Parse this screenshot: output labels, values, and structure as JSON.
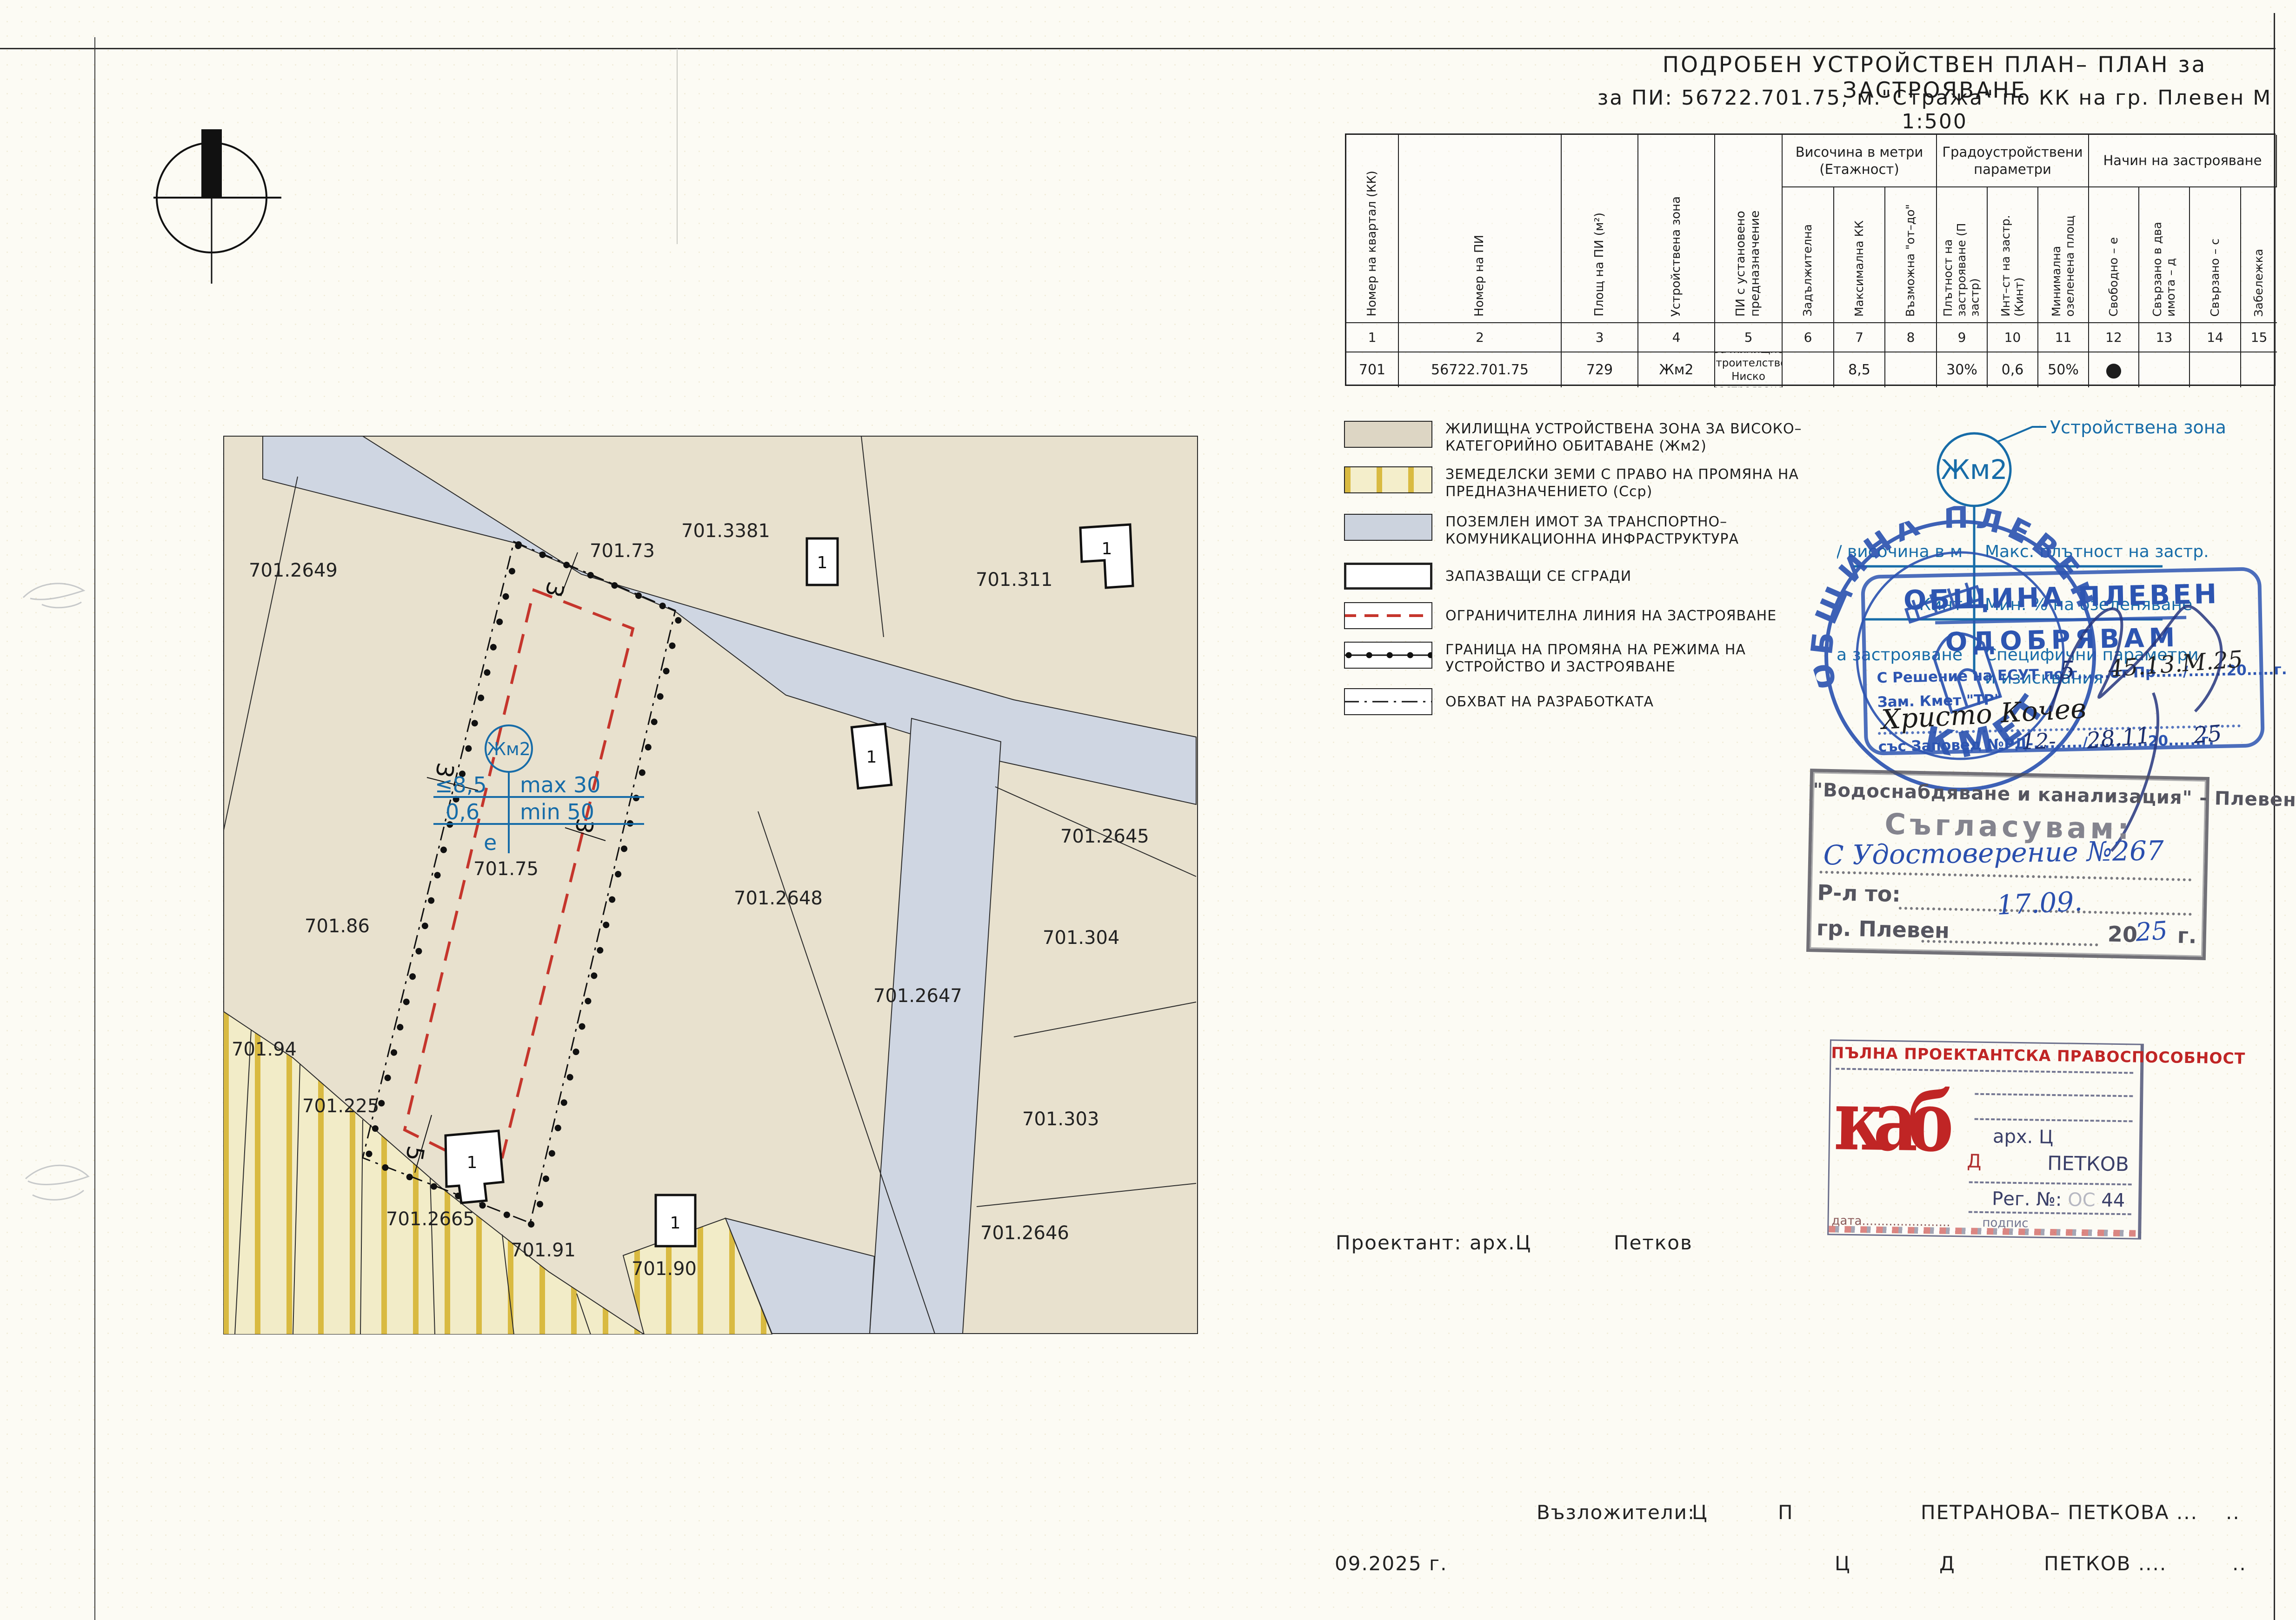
{
  "title": {
    "line1": "ПОДРОБЕН  УСТРОЙСТВЕН  ПЛАН– ПЛАН  за  ЗАСТРОЯВАНЕ",
    "line2": "за  ПИ: 56722.701.75,  м.\"Стража\"  по  КК  на  гр. Плевен  М 1:500"
  },
  "table": {
    "groups": [
      {
        "label": "Височина в метри (Етажност)"
      },
      {
        "label": "Градоустройствени параметри"
      },
      {
        "label": "Начин на застрояване"
      }
    ],
    "columns": [
      {
        "n": "1",
        "label": "Номер на квартал (КК)"
      },
      {
        "n": "2",
        "label": "Номер на ПИ"
      },
      {
        "n": "3",
        "label": "Площ на ПИ (м²)"
      },
      {
        "n": "4",
        "label": "Устройствена зона"
      },
      {
        "n": "5",
        "label": "ПИ с установено предназначение"
      },
      {
        "n": "6",
        "label": "Задължителна"
      },
      {
        "n": "7",
        "label": "Максимална КК"
      },
      {
        "n": "8",
        "label": "Възможна \"от–до\""
      },
      {
        "n": "9",
        "label": "Плътност на застрояване (П застр)"
      },
      {
        "n": "10",
        "label": "Инт–ст на застр. (Кинт)"
      },
      {
        "n": "11",
        "label": "Минимална озеленена площ"
      },
      {
        "n": "12",
        "label": "Свободно – е"
      },
      {
        "n": "13",
        "label": "Свързано в два имота – д"
      },
      {
        "n": "14",
        "label": "Свързано – с"
      },
      {
        "n": "15",
        "label": "Забележка"
      }
    ],
    "row": {
      "c1": "701",
      "c2": "56722.701.75",
      "c3": "729",
      "c4": "Жм2",
      "c5a": "За жилищно строителство",
      "c5b": "Ниско застрояване",
      "c6": "",
      "c7": "8,5",
      "c8": "",
      "c9": "30%",
      "c10": "0,6",
      "c11": "50%",
      "c12": "●",
      "c13": "",
      "c14": "",
      "c15": ""
    }
  },
  "legend": {
    "items": [
      {
        "label": "ЖИЛИЩНА УСТРОЙСТВЕНА ЗОНА ЗА ВИСОКО– КАТЕГОРИЙНО ОБИТАВАНЕ (Жм2)"
      },
      {
        "label": "ЗЕМЕДЕЛСКИ ЗЕМИ С ПРАВО НА ПРОМЯНА НА ПРЕДНАЗНАЧЕНИЕТО (Сср)"
      },
      {
        "label": "ПОЗЕМЛЕН ИМОТ ЗА ТРАНСПОРТНО– КОМУНИКАЦИОННА ИНФРАСТРУКТУРА"
      },
      {
        "label": "ЗАПАЗВАЩИ СЕ СГРАДИ"
      },
      {
        "label": "ОГРАНИЧИТЕЛНА ЛИНИЯ НА ЗАСТРОЯВАНЕ"
      },
      {
        "label": "ГРАНИЦА НА ПРОМЯНА НА РЕЖИМА НА УСТРОЙСТВО И ЗАСТРОЯВАНЕ"
      },
      {
        "label": "ОБХВАТ НА РАЗРАБОТКАТА"
      }
    ]
  },
  "zone_key": {
    "zone": "Жм2",
    "pointer": "Устройствена зона",
    "rows": [
      {
        "left": "етажност / височина в м",
        "right": "Макс. плътност на застр."
      },
      {
        "left": "Кинт",
        "right": "Мин. % на озеленяване"
      },
      {
        "left": "Начин на застрояване",
        "right": "Специфични параметри"
      }
    ],
    "right3b": "и изисквания"
  },
  "map": {
    "parcels": {
      "p2649": "701.2649",
      "p3381": "701.3381",
      "p311": "701.311",
      "p73": "701.73",
      "p86": "701.86",
      "p2645": "701.2645",
      "p2648": "701.2648",
      "p304": "701.304",
      "p2647": "701.2647",
      "p303": "701.303",
      "p2646": "701.2646",
      "p94": "701.94",
      "p225": "701.225",
      "p2665": "701.2665",
      "p91": "701.91",
      "p90": "701.90"
    },
    "subject": {
      "id": "701.75",
      "zone": "Жм2",
      "height": "≤8,5",
      "density": "max 30",
      "kint": "0,6",
      "green": "min 50",
      "way": "е"
    },
    "dims": {
      "d3": "3",
      "d5": "5"
    },
    "building_label": "1"
  },
  "stamps": {
    "round": {
      "org": "ОБЩИНА ПЛЕВЕН",
      "bottom": "КМЕТ"
    },
    "approve": {
      "org": "ОБЩИНА ПЛЕВЕН",
      "action": "ОДОБРЯВАМ",
      "line1": "С Решение на ЕСУТ по т......от Пр...../.......20.....г.",
      "hand1": "5",
      "hand2": "45.13.М.25",
      "line2": "Зам. Кмет \"ТР\"",
      "hand3": "Христо Кочев",
      "line3": "със Заповед №РД-........./...........20......г.",
      "hand4": "12-",
      "hand5": "28.11",
      "hand6": "25"
    },
    "vik": {
      "org": "\"Водоснабдяване и канализация\" - Плевен",
      "action": "Съгласувам:",
      "hand1": "С Удостоверение №267",
      "line1": "Р-л то:",
      "city": "гр. Плевен",
      "hand2": "17.09.",
      "year_prefix": "20",
      "hand3": "25",
      "year_suffix": "г."
    },
    "kab": {
      "header": "ПЪЛНА ПРОЕКТАНТСКА ПРАВОСПОСОБНОСТ",
      "logo": "каб",
      "arch": "арх. Ц",
      "initial": "Д",
      "name": "ПЕТКОВ",
      "reg": "Рег. №:",
      "reg_num": "44",
      "date_label": "дата.......................",
      "sign_label": "подпис"
    }
  },
  "footer": {
    "designer_label": "Проектант:",
    "designer_title": "арх.Ц",
    "designer_name": "Петков",
    "clients_label": "Възложители:",
    "c_init1": "Ц",
    "c_init2": "П",
    "c_name1": "ПЕТРАНОВА– ПЕТКОВА ...",
    "dots1": "..",
    "date": "09.2025 г.",
    "c2_init1": "Ц",
    "c2_init2": "Д",
    "c2_name": "ПЕТКОВ ....",
    "dots2": ".."
  },
  "colors": {
    "stamp_blue": "#2d55b1",
    "restriction_red": "#c5352c",
    "gold_stripe": "#d9ba41",
    "road_fill": "#cfd6e2",
    "parcel_fill": "#e8e1ce",
    "annotation_blue": "#176ca8"
  }
}
